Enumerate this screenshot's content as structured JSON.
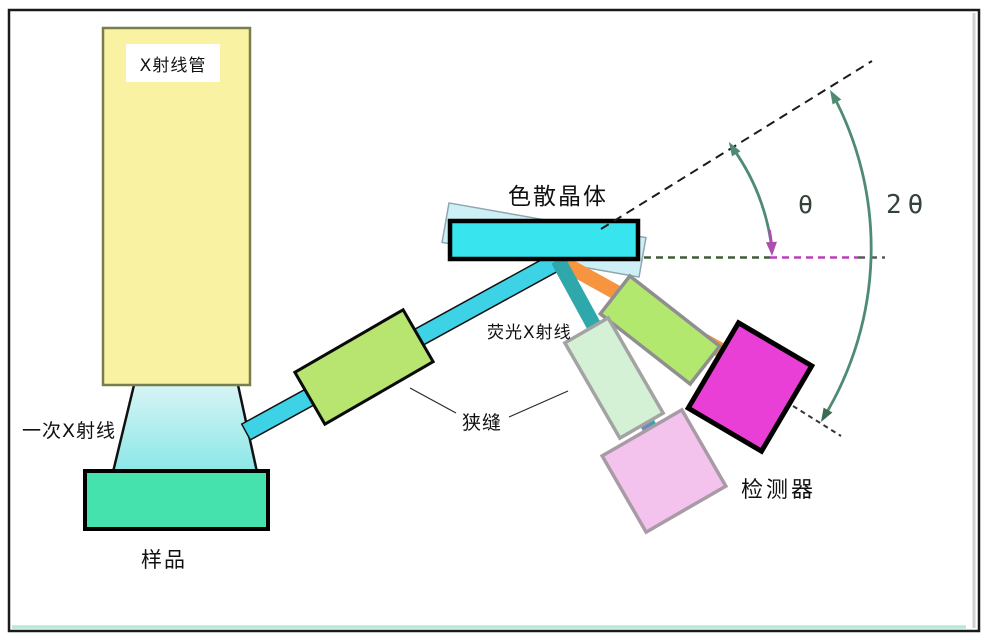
{
  "diagram": {
    "labels": {
      "xray_tube": "X射线管",
      "primary_xray": "一次X射线",
      "sample": "样品",
      "crystal": "色散晶体",
      "fluorescent_xray": "荧光X射线",
      "slit": "狭缝",
      "detector": "检测器",
      "theta": "θ",
      "two_theta": "2θ"
    },
    "colors": {
      "tube_fill": "#f8f2a2",
      "tube_border": "#77804d",
      "primary_beam_fill": "#9feaec",
      "sample_fill": "#45e2ae",
      "beam_cyan": "#3ed2e6",
      "slit_fill": "#b8e470",
      "crystal_fill": "#38e4ee",
      "ghost_fill": "#cdeff6",
      "diffracted_orange": "#f69440",
      "diffracted_teal": "#2fa8ab",
      "slit2_fill": "#b2e86e",
      "mint_fill": "#d4f1d6",
      "pink_fill": "#f3c3ee",
      "detector_fill": "#ea3fd6",
      "arc_green": "#4e8b72",
      "arrow_purple": "#aa4fae",
      "dash_olive": "#3f5d35",
      "dash_magenta": "#bb3fbb"
    }
  }
}
